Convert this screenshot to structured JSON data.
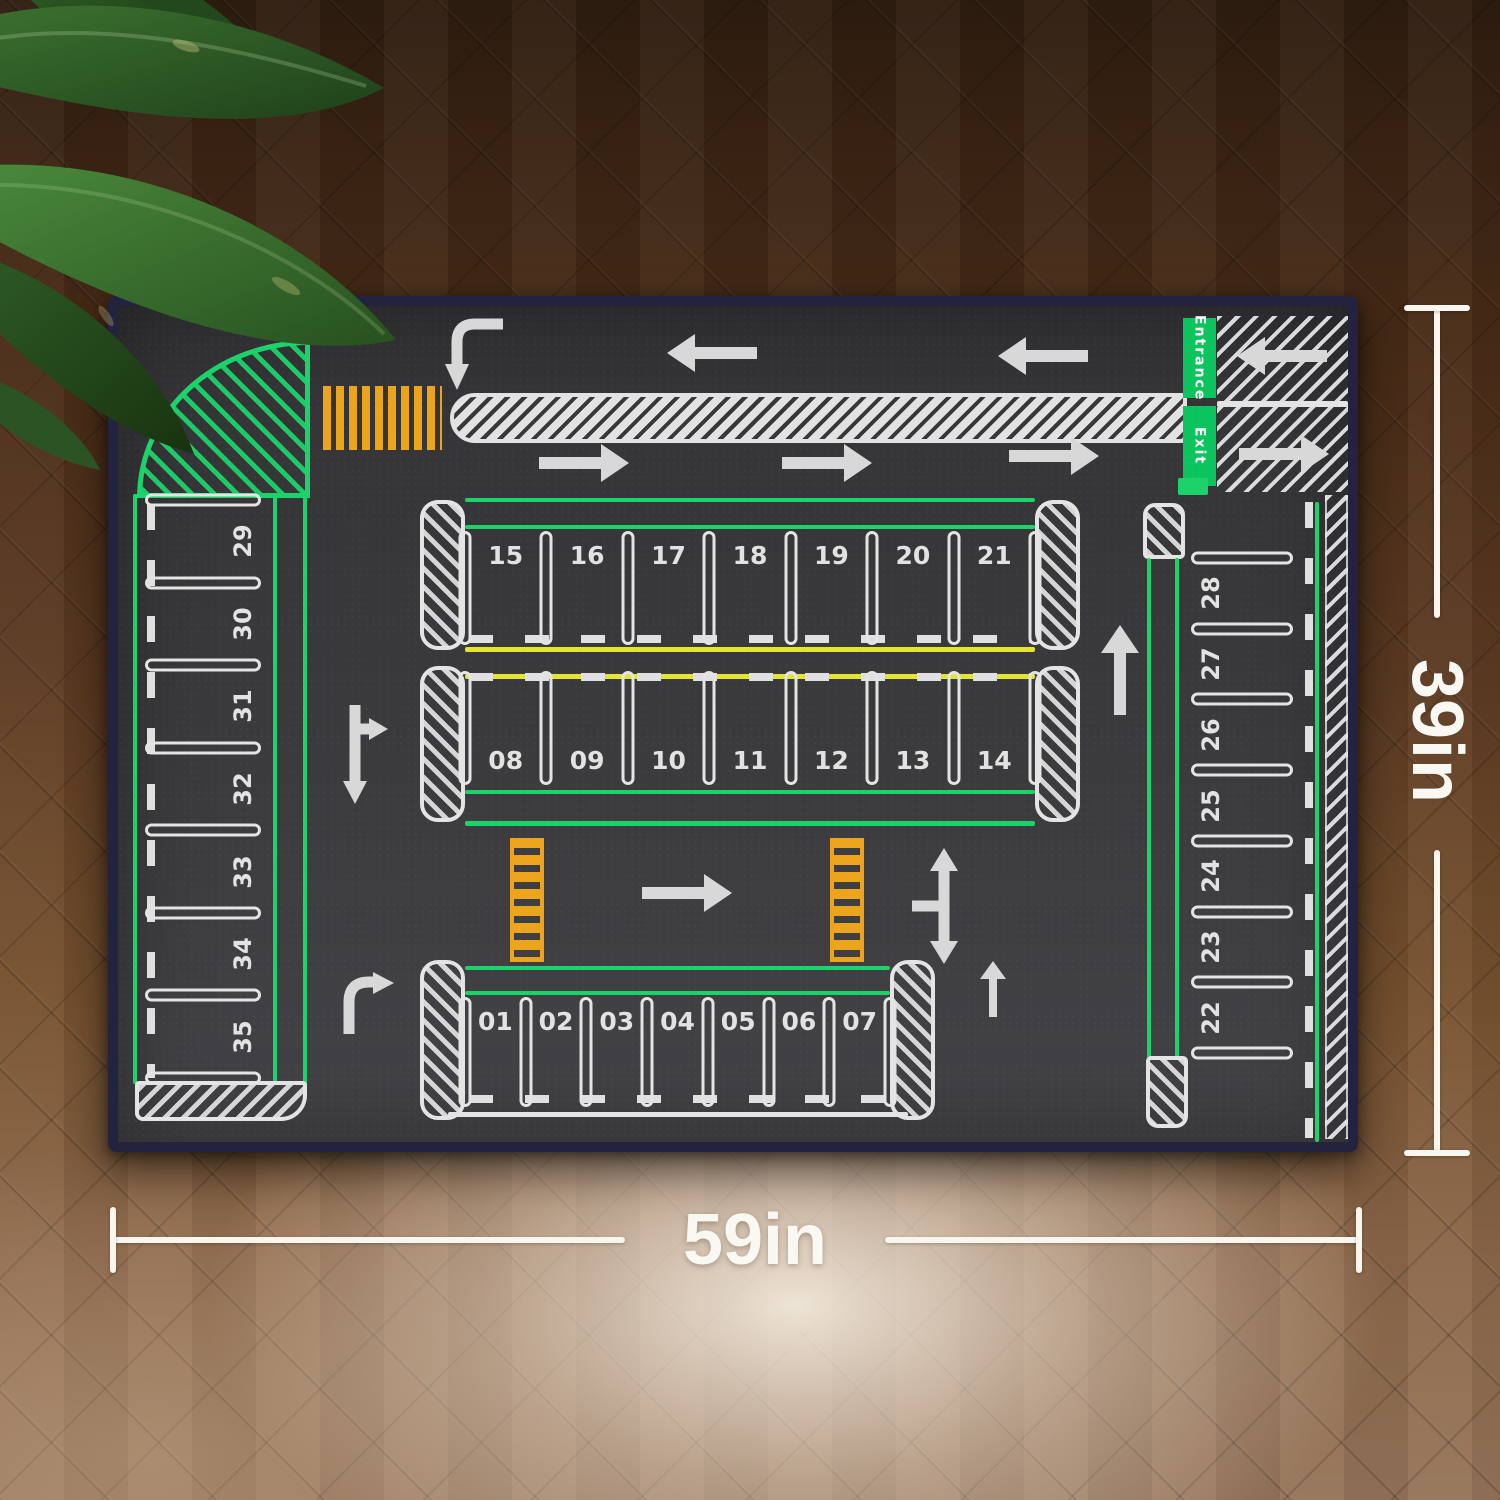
{
  "scene": {
    "description": "Kids parking-lot play mat photographed on a herringbone wood floor with a plant in the corner"
  },
  "dimensions": {
    "width_label": "59in",
    "height_label": "39in"
  },
  "mat": {
    "entrance_label": "Entrance",
    "exit_label": "Exit",
    "colors": {
      "surface": "#3a3a3d",
      "edge_binding": "#23233f",
      "marking_white": "#e4e4e4",
      "green": "#1bd36a",
      "entrance_green": "#0cc45e",
      "yellow": "#e4e432",
      "crosswalk_orange": "#eca41d",
      "arrow_gray": "#d8d8d8"
    },
    "parking": {
      "center_top_row": [
        "15",
        "16",
        "17",
        "18",
        "19",
        "20",
        "21"
      ],
      "center_bottom_row": [
        "08",
        "09",
        "10",
        "11",
        "12",
        "13",
        "14"
      ],
      "south_row": [
        "01",
        "02",
        "03",
        "04",
        "05",
        "06",
        "07"
      ],
      "west_column": [
        "29",
        "30",
        "31",
        "32",
        "33",
        "34",
        "35"
      ],
      "east_column": [
        "28",
        "27",
        "26",
        "25",
        "24",
        "23",
        "22"
      ]
    }
  }
}
